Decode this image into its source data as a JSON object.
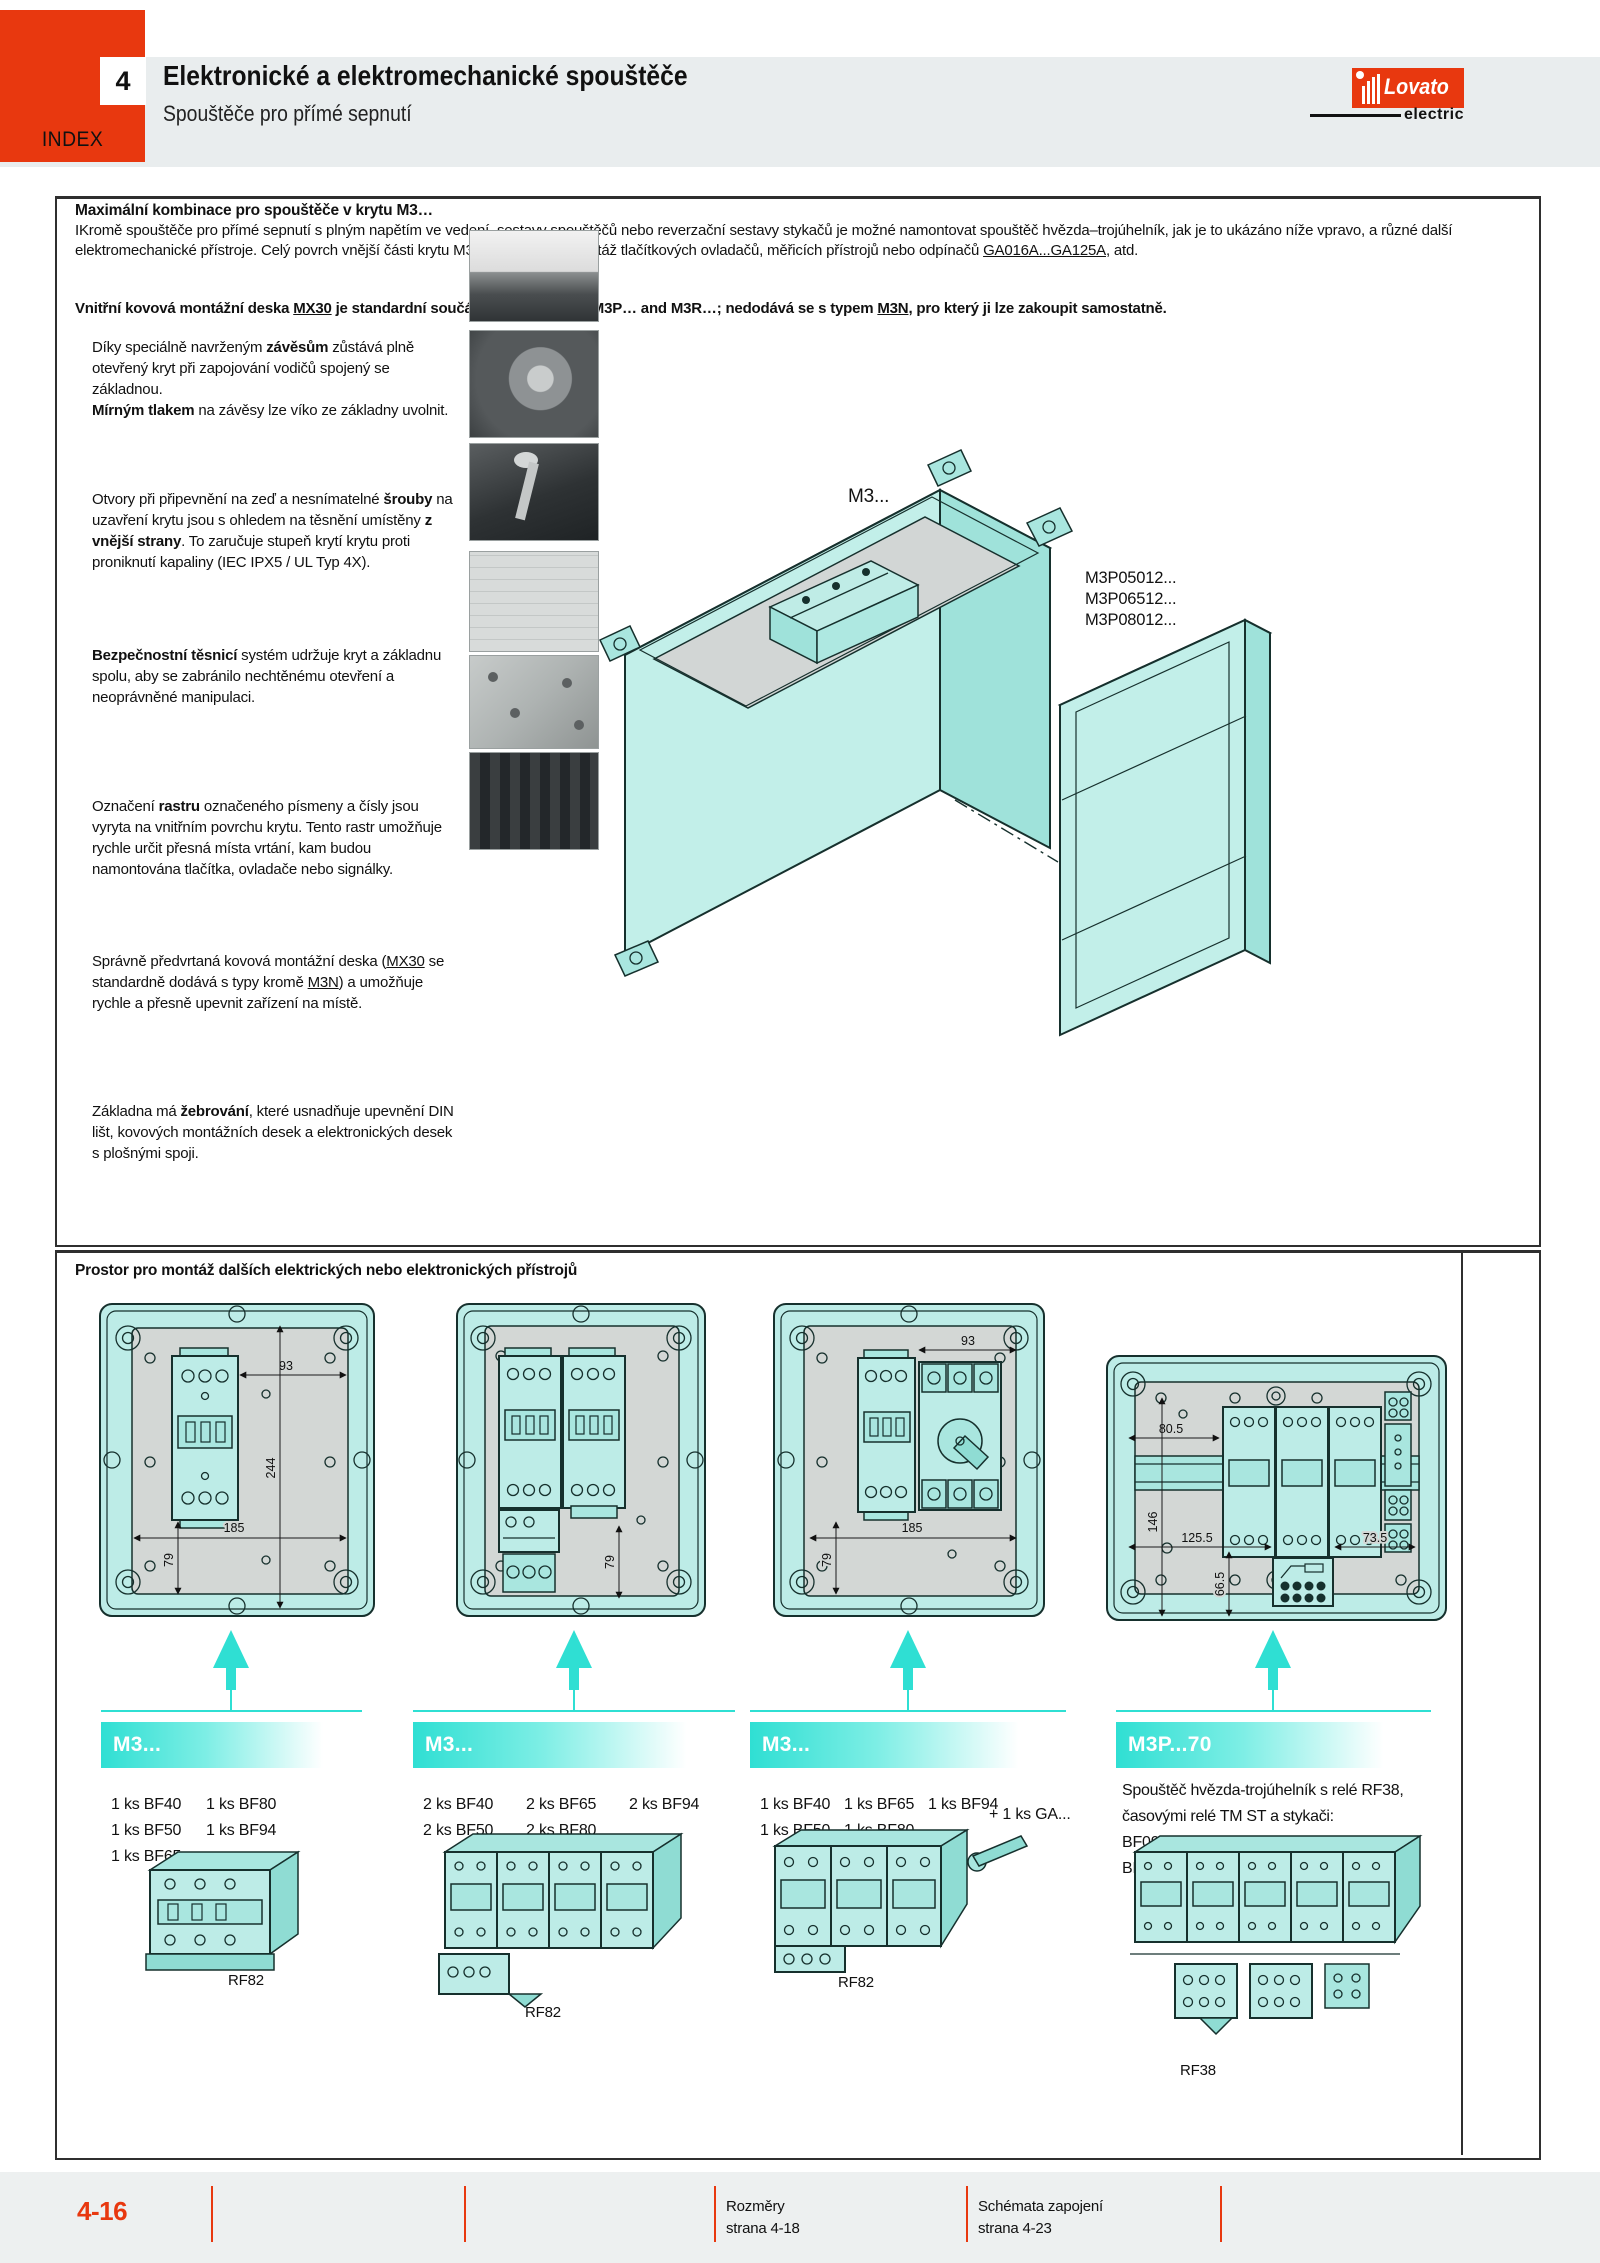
{
  "header": {
    "chapter": "4",
    "index": "INDEX",
    "title": "Elektronické a elektromechanické spouštěče",
    "subtitle": "Spouštěče pro přímé sepnutí",
    "logo_brand": "Lovato",
    "logo_sub": "electric"
  },
  "section1": {
    "heading": "Maximální kombinace pro spouštěče v krytu M3…",
    "intro_runs": [
      {
        "t": "IKromě spouštěče pro přímé sepnutí s plným napětím ve vedení, sestavy spouštěčů nebo reverzační sestavy stykačů je možné namontovat spouštěč hvězda–trojúhelník, jak je to ukázáno níže vpravo, a různé další elektromechanické přístroje. Celý povrch vnější části krytu M3 lze použít pro montáž tlačítkových ovladačů, měřicích přístrojů nebo odpínačů "
      },
      {
        "t": "GA016A...GA125A",
        "u": true
      },
      {
        "t": ", atd."
      }
    ],
    "note_runs": [
      {
        "t": "Vnitřní kovová montážní deska ",
        "b": true
      },
      {
        "t": "MX30",
        "b": true,
        "u": true
      },
      {
        "t": " je standardní součástí dodávky typů M3P… and M3R…; nedodává se s typem ",
        "b": true
      },
      {
        "t": "M3N",
        "b": true,
        "u": true
      },
      {
        "t": ", pro který ji lze zakoupit samostatně.",
        "b": true
      }
    ],
    "paragraphs": [
      {
        "runs": [
          {
            "t": "Díky speciálně navrženým "
          },
          {
            "t": "závěsům",
            "b": true
          },
          {
            "t": " zůstává plně otevřený kryt při zapojování vodičů spojený se základnou."
          },
          {
            "br": true
          },
          {
            "t": "Mírným tlakem",
            "b": true
          },
          {
            "t": " na závěsy lze víko ze základny uvolnit."
          }
        ]
      },
      {
        "runs": [
          {
            "t": "Otvory při připevnění na zeď a nesnímatelné "
          },
          {
            "t": "šrouby",
            "b": true
          },
          {
            "t": " na uzavření krytu jsou s ohledem na těsnění umístěny "
          },
          {
            "t": "z vnější strany",
            "b": true
          },
          {
            "t": ". To zaručuje stupeň krytí krytu proti proniknutí kapaliny (IEC IPX5 / UL Typ 4X)."
          }
        ]
      },
      {
        "runs": [
          {
            "t": "Bezpečnostní těsnicí",
            "b": true
          },
          {
            "t": " systém udržuje kryt a základnu spolu, aby se zabránilo nechtěnému otevření a neoprávněné manipulaci."
          }
        ]
      },
      {
        "runs": [
          {
            "t": "Označení "
          },
          {
            "t": "rastru",
            "b": true
          },
          {
            "t": " označeného písmeny a čísly jsou vyryta na vnitřním povrchu krytu. Tento rastr umožňuje rychle určit přesná místa vrtání, kam budou namontována tlačítka, ovladače nebo signálky."
          }
        ]
      },
      {
        "runs": [
          {
            "t": "Správně předvrtaná kovová montážní deska ("
          },
          {
            "t": "MX30",
            "u": true
          },
          {
            "t": " se standardně dodává s typy kromě "
          },
          {
            "t": "M3N",
            "u": true
          },
          {
            "t": ") a umožňuje rychle a přesně upevnit zařízení na místě."
          }
        ]
      },
      {
        "runs": [
          {
            "t": "Základna má "
          },
          {
            "t": "žebrování",
            "b": true
          },
          {
            "t": ", které usnadňuje upevnění DIN lišt, kovových montážních desek a elektronických desek s plošnými spoji."
          }
        ]
      }
    ],
    "photos": [
      "hinges-photo",
      "screw-photo",
      "sealing-photo",
      "raster-grid-photo",
      "mounting-plate-photo",
      "ribbing-photo"
    ],
    "illustration": {
      "label": "M3...",
      "part_numbers": [
        "M3P05012...",
        "M3P06512...",
        "M3P08012..."
      ]
    }
  },
  "section2": {
    "heading": "Prostor pro montáž dalších elektrických nebo elektronických přístrojů",
    "drawings": [
      {
        "dims": [
          "93",
          "244",
          "185",
          "79"
        ]
      },
      {
        "dims": [
          "79"
        ]
      },
      {
        "dims": [
          "93",
          "185",
          "79"
        ]
      },
      {
        "dims": [
          "80.5",
          "146",
          "125.5",
          "66.5",
          "73.5"
        ]
      }
    ],
    "columns": [
      {
        "header": "M3...",
        "rows": [
          [
            "1 ks BF40",
            "1 ks BF80"
          ],
          [
            "1 ks BF50",
            "1 ks BF94"
          ],
          [
            "1 ks BF65"
          ]
        ],
        "product_label": "RF82"
      },
      {
        "header": "M3...",
        "rows": [
          [
            "2 ks BF40",
            "2 ks BF65",
            "2 ks BF94"
          ],
          [
            "2 ks BF50",
            "2 ks BF80"
          ]
        ],
        "product_label": "RF82"
      },
      {
        "header": "M3...",
        "rows": [
          [
            "1 ks BF40",
            "1 ks BF65",
            "1 ks BF94"
          ],
          [
            "1 ks BF50",
            "1 ks BF80"
          ]
        ],
        "extra": "+ 1 ks GA...",
        "product_label": "RF82"
      },
      {
        "header": "M3P...70",
        "description": "Spouštěč hvězda-trojúhelník s relé RF38, časovými relé TM ST a stykači:",
        "rows": [
          [
            "BF09A",
            "BF12A",
            "BF18A"
          ],
          [
            "BF25A",
            "BF26A",
            "BF38A"
          ]
        ],
        "product_label": "RF38"
      }
    ]
  },
  "footer": {
    "page_number": "4-16",
    "links": [
      {
        "label": "Rozměry",
        "page": "strana 4-18"
      },
      {
        "label": "Schémata zapojení",
        "page": "strana 4-23"
      }
    ]
  },
  "colors": {
    "accent_red": "#e8380f",
    "cyan": "#2fdfd3",
    "drawing_fill": "#bdece7",
    "band_gray": "#e9edee",
    "plate_gray": "#d3d7d5"
  }
}
